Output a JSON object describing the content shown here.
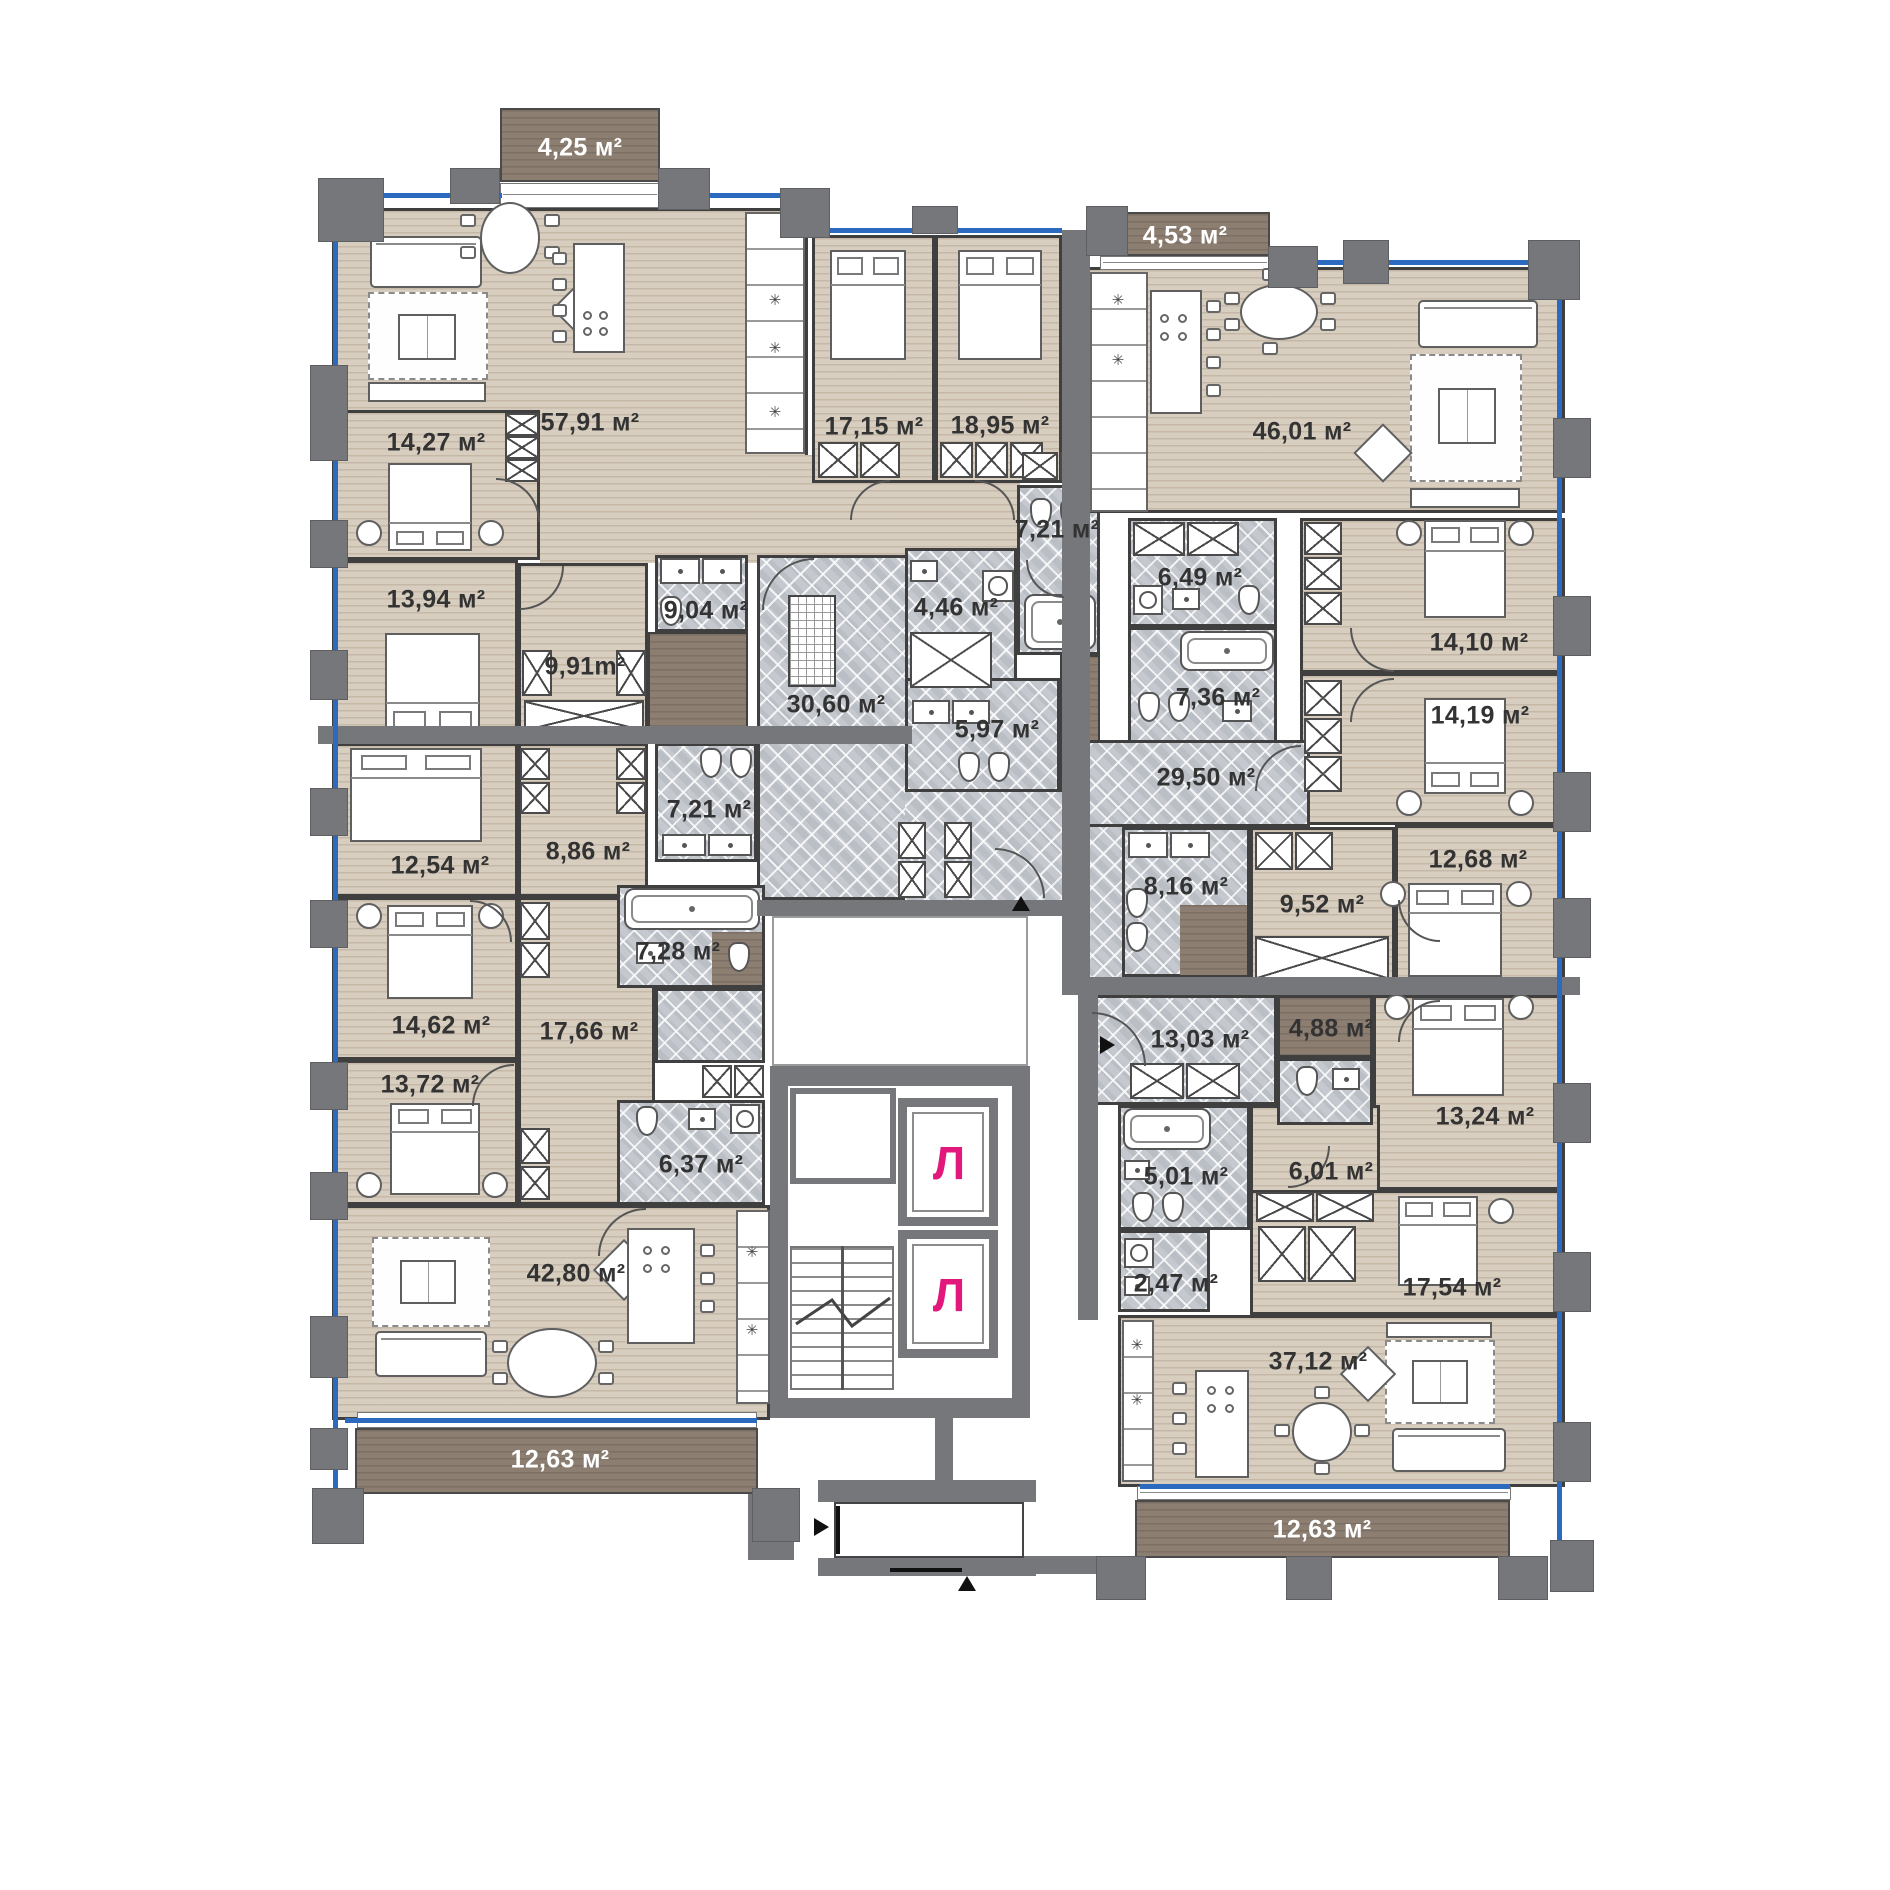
{
  "plan": {
    "type": "residential-floor-plan",
    "language": "ru",
    "units_suffix": "м²",
    "elevator_letter": "Л"
  },
  "labels": {
    "balcony_top_left": "4,25 м²",
    "balcony_top_right": "4,53 м²",
    "balcony_bottom_left": "12,63 м²",
    "balcony_bottom_right": "12,63 м²",
    "living_57_91": "57,91 м²",
    "bedroom_14_27": "14,27 м²",
    "bedroom_13_94": "13,94 м²",
    "hall_9_91": "9,91m²",
    "bath_9_04": "9,04 м²",
    "corridor_30_60": "30,60 м²",
    "bedroom_17_15": "17,15 м²",
    "bedroom_18_95": "18,95 м²",
    "bath_7_21_center": "7,21 м²",
    "bath_4_46": "4,46 м²",
    "bath_5_97": "5,97 м²",
    "bedroom_12_54": "12,54 м²",
    "hall_8_86": "8,86 м²",
    "bath_7_21_left": "7,21 м²",
    "bedroom_14_62": "14,62 м²",
    "bath_7_28": "7,28 м²",
    "corridor_17_66": "17,66 м²",
    "bedroom_13_72": "13,72 м²",
    "bath_6_37": "6,37 м²",
    "living_42_80": "42,80 м²",
    "living_46_01": "46,01 м²",
    "bath_6_49": "6,49 м²",
    "bath_7_36": "7,36 м²",
    "bedroom_14_10": "14,10 м²",
    "bedroom_14_19": "14,19 м²",
    "corridor_29_50": "29,50 м²",
    "bath_8_16": "8,16 м²",
    "hall_9_52": "9,52 м²",
    "bedroom_12_68": "12,68 м²",
    "hall_13_03": "13,03 м²",
    "bath_4_88": "4,88 м²",
    "bedroom_13_24": "13,24 м²",
    "bath_5_01": "5,01 м²",
    "hall_6_01": "6,01 м²",
    "utility_2_47": "2,47 м²",
    "bedroom_17_54": "17,54 м²",
    "living_37_12": "37,12 м²"
  },
  "colors": {
    "wood_floor": "#d8cec0",
    "tile_floor": "#c5c9cf",
    "balcony": "#8d7e72",
    "wall": "#75777b",
    "window_line": "#2b6abe",
    "elevator_letter": "#e2187d"
  }
}
